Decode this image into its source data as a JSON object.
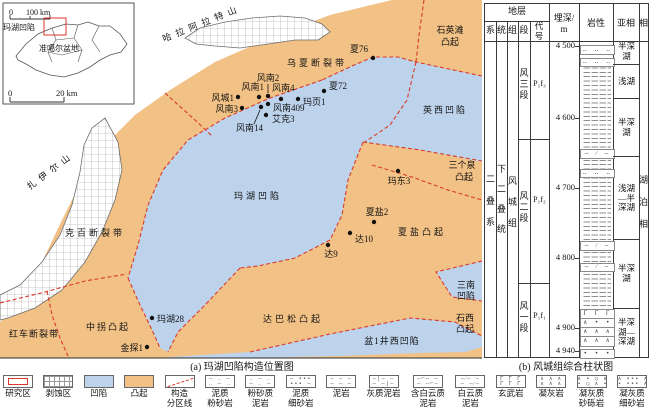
{
  "colors": {
    "uplift_orange": "#f2c185",
    "sag_blue": "#bdd3ec",
    "fault_line_red": "#d93a2b",
    "hatch_grey": "#9a9a9a"
  },
  "captions": {
    "a": "(a) 玛湖凹陷构造位置图",
    "b": "(b) 风城组综合柱状图"
  },
  "inset": {
    "scale_zero": "0",
    "scale_end": "100 km",
    "highlight": "玛湖凹陷",
    "basin": "准噶尔盆地"
  },
  "scalebar": {
    "zero": "0",
    "end": "20 km"
  },
  "map": {
    "mountains": [
      {
        "name": "哈拉阿拉特山"
      },
      {
        "name": "扎伊尔山"
      }
    ],
    "regions": [
      {
        "name": "乌夏断裂带",
        "type": "fault-belt",
        "lines": [
          "乌夏断裂带"
        ]
      },
      {
        "name": "石英滩凸起",
        "type": "uplift",
        "lines": [
          "石英滩",
          "凸起"
        ]
      },
      {
        "name": "英西凹陷",
        "type": "sag",
        "lines": [
          "英西凹陷"
        ]
      },
      {
        "name": "三个泉凸起",
        "type": "uplift",
        "lines": [
          "三个泉",
          "凸起"
        ]
      },
      {
        "name": "玛湖凹陷",
        "type": "sag",
        "lines": [
          "玛湖凹陷"
        ]
      },
      {
        "name": "夏盐凸起",
        "type": "uplift",
        "lines": [
          "夏盐凸起"
        ]
      },
      {
        "name": "三南凹陷",
        "type": "sag",
        "lines": [
          "三南",
          "凹陷"
        ]
      },
      {
        "name": "石西凸起",
        "type": "uplift",
        "lines": [
          "石西",
          "凸起"
        ]
      },
      {
        "name": "达巴松凸起",
        "type": "uplift",
        "lines": [
          "达巴松凸起"
        ]
      },
      {
        "name": "盆1井西凹陷",
        "type": "sag",
        "lines": [
          "盆1井西凹陷"
        ]
      },
      {
        "name": "克百断裂带",
        "type": "fault-belt",
        "lines": [
          "克百断裂带"
        ]
      },
      {
        "name": "红车断裂带",
        "type": "fault-belt",
        "lines": [
          "红车断裂带"
        ]
      },
      {
        "name": "中拐凸起",
        "type": "uplift",
        "lines": [
          "中拐凸起"
        ]
      }
    ],
    "wells": [
      {
        "name": "夏76"
      },
      {
        "name": "风南2"
      },
      {
        "name": "风南1"
      },
      {
        "name": "风南4"
      },
      {
        "name": "夏72"
      },
      {
        "name": "风城1"
      },
      {
        "name": "玛页1"
      },
      {
        "name": "风南3"
      },
      {
        "name": "风南409"
      },
      {
        "name": "艾克3"
      },
      {
        "name": "风南14"
      },
      {
        "name": "玛东3"
      },
      {
        "name": "夏盐2"
      },
      {
        "name": "达10"
      },
      {
        "name": "达9"
      },
      {
        "name": "玛湖28"
      },
      {
        "name": "金探1"
      }
    ]
  },
  "column": {
    "headers": {
      "strata": "地层",
      "system": "系",
      "series": "统",
      "formation": "组",
      "member": "段",
      "code": "代号",
      "depth": "埋深/",
      "depth_unit": "m",
      "lithology": "岩性",
      "subfacies": "亚相",
      "facies": "相"
    },
    "system": "二叠系",
    "series": "下二叠统",
    "formation": "风城组",
    "members": [
      {
        "name": "风三段",
        "code": "P₁f₃"
      },
      {
        "name": "风二段",
        "code": "P₁f₂"
      },
      {
        "name": "风一段",
        "code": "P₁f₁"
      }
    ],
    "depth_ticks": [
      "4 500",
      "4 600",
      "4 700",
      "4 800",
      "4 900",
      "4 940"
    ],
    "subfacies": [
      {
        "label": "半深湖"
      },
      {
        "label": "浅湖"
      },
      {
        "label": "半深湖"
      },
      {
        "label": "浅湖—半深湖"
      },
      {
        "label": "半深湖"
      },
      {
        "label": "半深湖—深湖"
      }
    ],
    "facies": "湖泊相",
    "lith_glyphs": {
      "sand_dots": "‥ ‥ ‥",
      "slash": "— ⁄ —",
      "basalt": "Γ Γ Γ",
      "tuff": "∧ ∧ ∧",
      "gravel": "∧ • • ∧",
      "dots": "• • •"
    }
  },
  "legend": {
    "items": [
      {
        "label": "研究区",
        "type": "research"
      },
      {
        "label": "剥蚀区",
        "type": "erosion"
      },
      {
        "label": "凹陷",
        "type": "sag"
      },
      {
        "label": "凸起",
        "type": "uplift"
      },
      {
        "label": "构造\n分区线",
        "type": "tectonic-line"
      },
      {
        "label": "泥质\n粉砂岩",
        "type": "pattern",
        "glyphs": [
          "— ‥ —",
          "‥ — ‥"
        ]
      },
      {
        "label": "粉砂质\n泥岩",
        "type": "pattern",
        "glyphs": [
          "‥ — ‥",
          "— ‥ —"
        ]
      },
      {
        "label": "泥质\n细砂岩",
        "type": "pattern",
        "glyphs": [
          "— ••• ",
          "••• —"
        ]
      },
      {
        "label": "泥岩",
        "type": "pattern",
        "glyphs": [
          "— — —",
          "— — —"
        ]
      },
      {
        "label": "灰质泥岩",
        "type": "pattern",
        "glyphs": [
          "—|— —",
          "— —|—"
        ]
      },
      {
        "label": "含白云质\n泥岩",
        "type": "pattern",
        "glyphs": [
          "—⌐— —",
          "— —⌐—"
        ]
      },
      {
        "label": "白云质\n泥岩",
        "type": "pattern",
        "glyphs": [
          "—⁄— —",
          "— —⁄—"
        ]
      },
      {
        "label": "玄武岩",
        "type": "pattern",
        "glyphs": [
          "Γ Γ Γ",
          "Γ Γ Γ"
        ]
      },
      {
        "label": "凝灰岩",
        "type": "pattern",
        "glyphs": [
          "∧ ∧ ∧",
          "∧ ∧ ∧"
        ]
      },
      {
        "label": "凝灰质\n砂砾岩",
        "type": "pattern",
        "glyphs": [
          "∧ • ○ ∧",
          "• ○ ∧ •"
        ]
      },
      {
        "label": "凝灰质\n细砂岩",
        "type": "pattern",
        "glyphs": [
          "∧ ••• ∧",
          "• ••• ∧"
        ]
      }
    ]
  }
}
